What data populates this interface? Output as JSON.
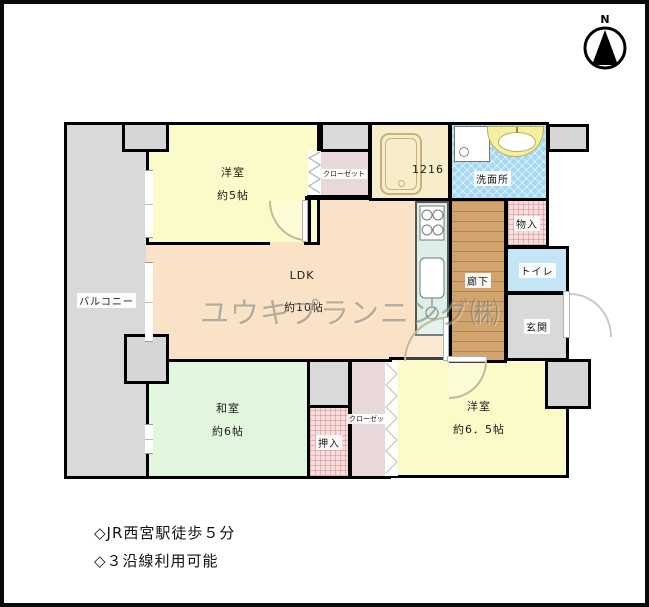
{
  "compass": {
    "label": "N"
  },
  "watermark": {
    "text": "ユウキプランニング㈱"
  },
  "rooms": {
    "balcony": {
      "name": "バルコニー"
    },
    "bedroom_west": {
      "name": "洋室",
      "size": "約5帖"
    },
    "ldk": {
      "name": "LDK",
      "size": "約10帖"
    },
    "japanese_room": {
      "name": "和室",
      "size": "約6帖"
    },
    "bedroom_south": {
      "name": "洋室",
      "size": "約6．5帖"
    },
    "bath": {
      "size_label": "1216"
    },
    "washroom": {
      "name": "洗面所"
    },
    "hallway": {
      "name": "廊下"
    },
    "storage": {
      "name": "物入"
    },
    "toilet": {
      "name": "トイレ"
    },
    "entrance": {
      "name": "玄関"
    },
    "oshiire": {
      "name": "押入"
    },
    "closet_north": {
      "name": "クローゼット"
    },
    "closet_south": {
      "name": "クローゼット"
    }
  },
  "notes": {
    "line1": "◇JR西宮駅徒歩５分",
    "line2": "◇３沿線利用可能"
  },
  "colors": {
    "wall": "#000000",
    "balcony_gray": "#d9d9d9",
    "bedroom_yellow": "#fbfbc9",
    "ldk_peach": "#f9e2c5",
    "tatami_green": "#e2f6dd",
    "closet_pink": "#e9d8da",
    "hatch_pink": "#f7dddd",
    "washroom_blue": "#a5d9f0",
    "toilet_blue": "#c3e5f6",
    "hallway_wood": "#d2a46d",
    "kitchen_mint": "#daf0e6",
    "bath_cream": "#f7edca",
    "counter_yellow": "#f5ef9e"
  }
}
